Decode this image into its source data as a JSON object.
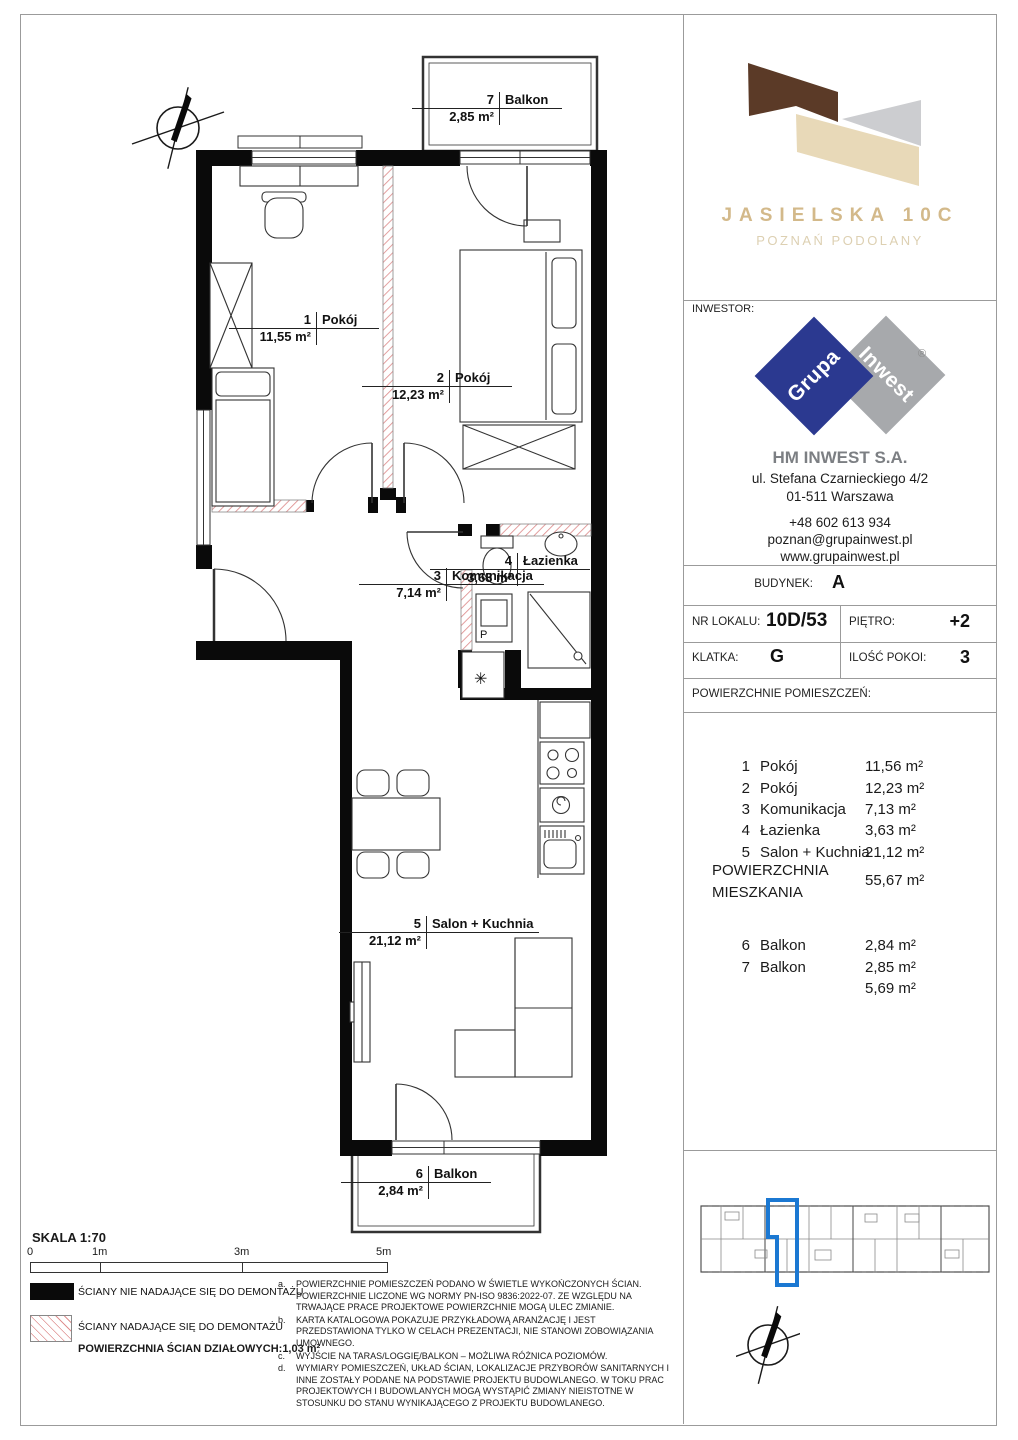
{
  "project": {
    "title": "JASIELSKA 10C",
    "subtitle": "POZNAŃ PODOLANY"
  },
  "investor": {
    "label": "INWESTOR:",
    "logo_word1": "Grupa",
    "logo_word2": "Inwest",
    "registered": "®",
    "company": "HM INWEST S.A.",
    "address1": "ul. Stefana Czarnieckiego 4/2",
    "address2": "01-511 Warszawa",
    "phone": "+48 602 613 934",
    "email": "poznan@grupainwest.pl",
    "website": "www.grupainwest.pl"
  },
  "unit": {
    "building_label": "BUDYNEK:",
    "building": "A",
    "number_label": "NR LOKALU:",
    "number": "10D/53",
    "floor_label": "PIĘTRO:",
    "floor": "+2",
    "staircase_label": "KLATKA:",
    "staircase": "G",
    "rooms_label": "ILOŚĆ POKOI:",
    "rooms": "3",
    "areas_header": "POWIERZCHNIE POMIESZCZEŃ:"
  },
  "areas": {
    "rooms": [
      {
        "no": "1",
        "name": "Pokój",
        "area": "11,56 m²"
      },
      {
        "no": "2",
        "name": "Pokój",
        "area": "12,23 m²"
      },
      {
        "no": "3",
        "name": "Komunikacja",
        "area": "7,13 m²"
      },
      {
        "no": "4",
        "name": "Łazienka",
        "area": "3,63 m²"
      },
      {
        "no": "5",
        "name": "Salon + Kuchnia",
        "area": "21,12 m²"
      }
    ],
    "total_label_line1": "POWIERZCHNIA",
    "total_label_line2": "MIESZKANIA",
    "total_area": "55,67 m²",
    "balconies": [
      {
        "no": "6",
        "name": "Balkon",
        "area": "2,84 m²"
      },
      {
        "no": "7",
        "name": "Balkon",
        "area": "2,85 m²"
      }
    ],
    "balconies_total": "5,69 m²"
  },
  "plan": {
    "labels": [
      {
        "no": "7",
        "name": "Balkon",
        "area": "2,85 m²"
      },
      {
        "no": "1",
        "name": "Pokój",
        "area": "11,55 m²"
      },
      {
        "no": "2",
        "name": "Pokój",
        "area": "12,23 m²"
      },
      {
        "no": "3",
        "name": "Komunikacja",
        "area": "7,14 m²"
      },
      {
        "no": "4",
        "name": "Łazienka",
        "area": "3,63 m²"
      },
      {
        "no": "5",
        "name": "Salon + Kuchnia",
        "area": "21,12 m²"
      },
      {
        "no": "6",
        "name": "Balkon",
        "area": "2,84 m²"
      }
    ],
    "symbols": {
      "washer": "P",
      "light": "✳"
    }
  },
  "footer": {
    "scale_label": "SKALA 1:70",
    "ticks": [
      "0",
      "1m",
      "3m",
      "5m"
    ],
    "legend": [
      {
        "label": "ŚCIANY NIE NADAJĄCE SIĘ DO DEMONTAŻU"
      },
      {
        "label": "ŚCIANY NADAJĄCE SIĘ DO DEMONTAŻU"
      }
    ],
    "partition_label": "POWIERZCHNIA ŚCIAN DZIAŁOWYCH:",
    "partition_value": "1,03 m²",
    "notes": [
      {
        "key": "a.",
        "text": "POWIERZCHNIE POMIESZCZEŃ PODANO W ŚWIETLE WYKOŃCZONYCH ŚCIAN. POWIERZCHNIE LICZONE WG NORMY PN-ISO 9836:2022-07. ZE WZGLĘDU NA TRWAJĄCE PRACE PROJEKTOWE POWIERZCHNIE MOGĄ ULEC ZMIANIE."
      },
      {
        "key": "b.",
        "text": "KARTA KATALOGOWA POKAZUJE PRZYKŁADOWĄ ARANŻACJĘ I JEST PRZEDSTAWIONA TYLKO W CELACH PREZENTACJI, NIE STANOWI ZOBOWIĄZANIA UMOWNEGO."
      },
      {
        "key": "c.",
        "text": "WYJŚCIE NA TARAS/LOGGIĘ/BALKON – MOŻLIWA RÓŻNICA POZIOMÓW."
      },
      {
        "key": "d.",
        "text": "WYMIARY POMIESZCZEŃ, UKŁAD ŚCIAN, LOKALIZACJE PRZYBORÓW SANITARNYCH I INNE ZOSTAŁY PODANE NA PODSTAWIE PROJEKTU BUDOWLANEGO. W TOKU PRAC PROJEKTOWYCH I BUDOWLANYCH MOGĄ WYSTĄPIĆ ZMIANY NIEISTOTNE W STOSUNKU DO STANU WYNIKAJĄCEGO Z PROJEKTU BUDOWLANEGO."
      }
    ]
  },
  "colors": {
    "accent_blue": "#1b78d2",
    "logo_brown": "#5b3a27",
    "logo_beige": "#e8d9b8",
    "logo_gray": "#cccdd0",
    "title_beige": "#d3b98a",
    "brand_navy": "#2b3990",
    "brand_gray": "#a7a9ac",
    "hatch_red": "#df9090"
  }
}
